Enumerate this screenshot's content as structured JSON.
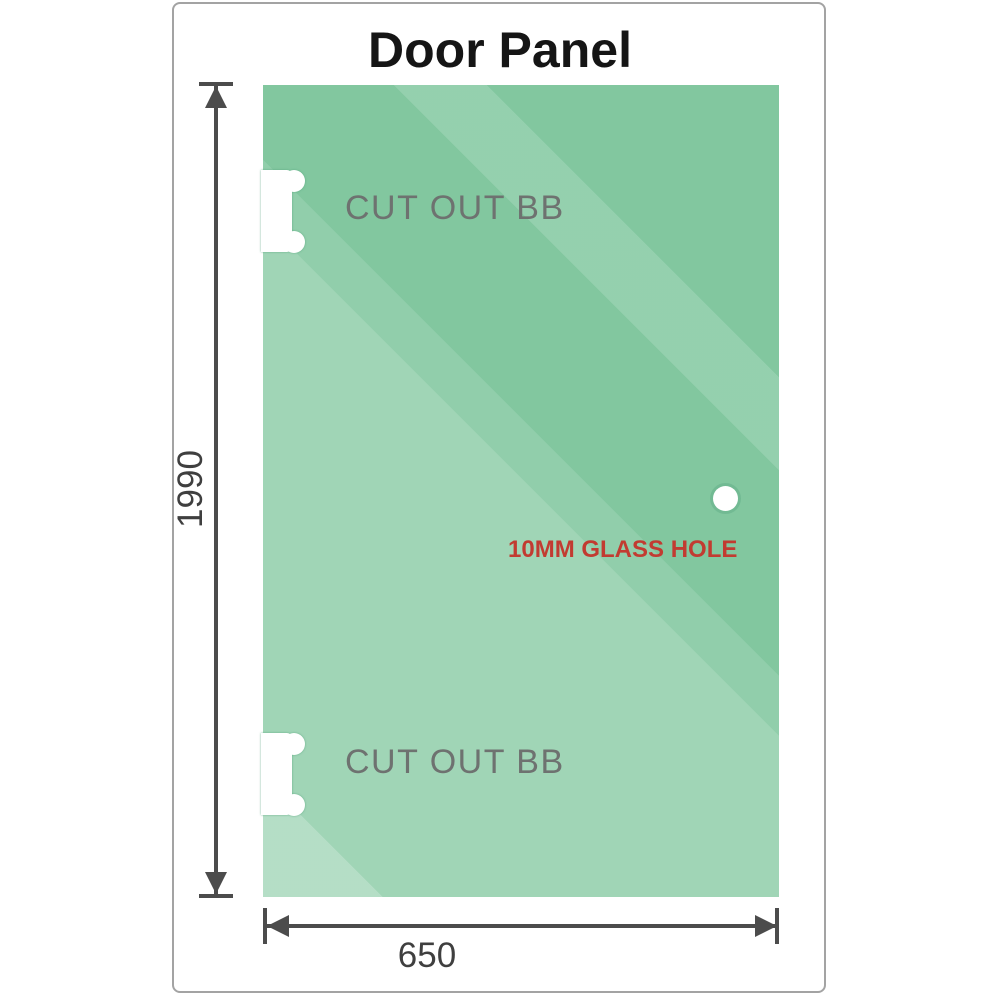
{
  "title": "Door Panel",
  "dimensions": {
    "height_mm": "1990",
    "width_mm": "650"
  },
  "annotations": {
    "cutout_top": "CUT OUT BB",
    "cutout_bottom": "CUT OUT BB",
    "glass_hole": "10MM GLASS HOLE"
  },
  "colors": {
    "glass-base": "#7fc69d",
    "frame-border": "#a3a3a3",
    "dim-line": "#4c4c4c",
    "dim-text": "#3f3f3f",
    "cutout-text": "#6e7270",
    "hole-text": "#c23b31"
  }
}
